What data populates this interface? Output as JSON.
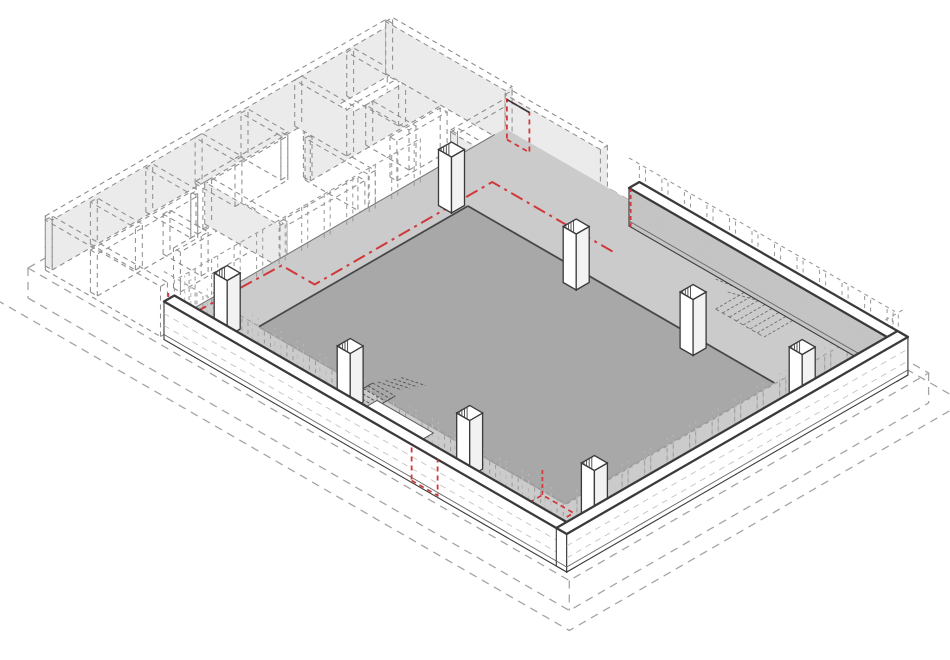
{
  "figure": {
    "description": "Axonometric demolition diagram: existing masonry walls shown dashed for removal, retained low perimeter walls on three sides, concrete floor slab with perimeter bands, eight columns with hatched tops, two stairs, red dash-dot lines and red dashed door openings marking demolition, all on a dashed base plinth"
  },
  "projection": {
    "ox": 28,
    "oy": 268,
    "c": 0.866,
    "s": 0.5
  },
  "colors": {
    "bg": "#ffffff",
    "slab_dark": "#a8a8a8",
    "slab_light": "#cbcbcb",
    "wall_white": "#ffffff",
    "wall_gray_face": "#c4c4c4",
    "col_side": "#f2f2f2",
    "line_dark": "#3a3a3a",
    "slab_edge": "#474747",
    "soft_edge": "#9b9b9b",
    "maze_line": "#8f8f8f",
    "maze_fill": "#ebebeb",
    "plinth_line": "#a5a5a5",
    "ghost_line": "#9c9c9c",
    "pier_light": "#b9b9b9",
    "course_line": "#c2c2c2",
    "stair_line": "#555555",
    "stairb_line": "#707070",
    "hatch": "#444444",
    "red": "#cf393b"
  },
  "plinth": {
    "A": 415,
    "B": 625,
    "depth": 30,
    "step": 20
  },
  "floors": {
    "light": {
      "u0": 19,
      "u1": 389,
      "v0": 150,
      "v1": 603,
      "z": 14
    },
    "dark": {
      "u0": 60,
      "u1": 302,
      "v0": 206,
      "v1": 560,
      "z": 14
    }
  },
  "walls": [
    {
      "name": "perimeter-wall-southwest",
      "u0": 7,
      "u1": 19,
      "v0": 150,
      "v1": 615,
      "h": 38,
      "mu": "wall_white",
      "pv": "wall_white"
    },
    {
      "name": "perimeter-wall-northeast",
      "u0": 389,
      "u1": 401,
      "v0": 305,
      "v1": 615,
      "h": 38,
      "mu": "wall_gray_face",
      "pv": "wall_white"
    },
    {
      "name": "perimeter-wall-southeast",
      "u0": 7,
      "u1": 401,
      "v0": 603,
      "v1": 615,
      "h": 38,
      "mu": "wall_white",
      "pv": "wall_white"
    }
  ],
  "ghost_planes": [
    {
      "name": "ghost-wall-above-southwest",
      "ax": "u",
      "at": 7,
      "a": 150,
      "b": 612,
      "z0": 38,
      "z1": 68,
      "color": "ghost_line",
      "top": true
    },
    {
      "name": "ghost-wall-above-northeast",
      "ax": "u",
      "at": 389,
      "a": 305,
      "b": 612,
      "z0": 38,
      "z1": 68,
      "color": "ghost_line",
      "top": true
    },
    {
      "name": "ghost-wall-above-southeast",
      "ax": "v",
      "at": 615,
      "a": 7,
      "b": 398,
      "z0": 38,
      "z1": 68,
      "color": "ghost_line",
      "top": true
    },
    {
      "name": "ghost-piers-inner-southwest",
      "ax": "u",
      "at": 19,
      "a": 150,
      "b": 600,
      "z0": 14,
      "z1": 64,
      "color": "pier_light",
      "top": false
    },
    {
      "name": "ghost-piers-inner-southeast",
      "ax": "v",
      "at": 603,
      "a": 19,
      "b": 389,
      "z0": 14,
      "z1": 64,
      "color": "pier_light",
      "top": false
    },
    {
      "name": "ghost-wall-northwest-edge",
      "ax": "v",
      "at": 155,
      "a": 19,
      "b": 296,
      "z0": 14,
      "z1": 58,
      "color": "ghost_line",
      "top": true
    }
  ],
  "ghost_spacing": 26,
  "courses": [
    {
      "ax": "u",
      "at": 7,
      "a": 150,
      "b": 615,
      "z": [
        14,
        26
      ]
    },
    {
      "ax": "v",
      "at": 615,
      "a": 7,
      "b": 401,
      "z": [
        14,
        26
      ]
    },
    {
      "ax": "u",
      "at": 389,
      "a": 305,
      "b": 615,
      "z": [
        14,
        26
      ]
    }
  ],
  "maze_walls": [
    {
      "t": "u",
      "at": 12,
      "a": 12,
      "b": 405,
      "h": 50,
      "f": 1
    },
    {
      "t": "u",
      "at": 64,
      "a": 12,
      "b": 128,
      "h": 42,
      "f": 0
    },
    {
      "t": "u",
      "at": 58,
      "a": 140,
      "b": 238,
      "h": 44,
      "f": 0
    },
    {
      "t": "u",
      "at": 72,
      "a": 250,
      "b": 405,
      "h": 44,
      "f": 1
    },
    {
      "t": "u",
      "at": 108,
      "a": 64,
      "b": 150,
      "h": 40,
      "f": 0
    },
    {
      "t": "u",
      "at": 145,
      "a": 150,
      "b": 240,
      "h": 42,
      "f": 0
    },
    {
      "t": "u",
      "at": 122,
      "a": 300,
      "b": 358,
      "h": 40,
      "f": 0
    },
    {
      "t": "v",
      "at": 12,
      "a": 12,
      "b": 145,
      "h": 50,
      "f": 0
    },
    {
      "t": "v",
      "at": 64,
      "a": 12,
      "b": 64,
      "h": 42,
      "f": 0
    },
    {
      "t": "v",
      "at": 96,
      "a": 64,
      "b": 108,
      "h": 40,
      "f": 0
    },
    {
      "t": "v",
      "at": 128,
      "a": 12,
      "b": 64,
      "h": 44,
      "f": 0
    },
    {
      "t": "v",
      "at": 150,
      "a": 58,
      "b": 145,
      "h": 42,
      "f": 1
    },
    {
      "t": "v",
      "at": 185,
      "a": 12,
      "b": 58,
      "h": 46,
      "f": 0
    },
    {
      "t": "v",
      "at": 238,
      "a": 12,
      "b": 58,
      "h": 44,
      "f": 0
    },
    {
      "t": "v",
      "at": 252,
      "a": 72,
      "b": 145,
      "h": 42,
      "f": 0
    },
    {
      "t": "v",
      "at": 300,
      "a": 12,
      "b": 72,
      "h": 46,
      "f": 1
    },
    {
      "t": "v",
      "at": 322,
      "a": 72,
      "b": 122,
      "h": 40,
      "f": 0
    },
    {
      "t": "v",
      "at": 360,
      "a": 12,
      "b": 72,
      "h": 44,
      "f": 0
    },
    {
      "t": "v",
      "at": 405,
      "a": 12,
      "b": 150,
      "h": 52,
      "f": 1
    },
    {
      "t": "v",
      "at": 340,
      "a": 152,
      "b": 300,
      "h": 44,
      "f": 1
    },
    {
      "t": "u",
      "at": 152,
      "a": 340,
      "b": 403,
      "h": 42,
      "f": 0
    },
    {
      "t": "u",
      "at": 185,
      "a": 340,
      "b": 403,
      "h": 42,
      "f": 0
    },
    {
      "t": "u",
      "at": 240,
      "a": 340,
      "b": 403,
      "h": 40,
      "f": 0
    },
    {
      "t": "v",
      "at": 403,
      "a": 152,
      "b": 262,
      "h": 50,
      "f": 1
    }
  ],
  "maze_thickness": 8,
  "columns": {
    "size": 15,
    "base_z": 14,
    "height": 56,
    "positions": [
      {
        "u": 293,
        "v": 196
      },
      {
        "u": 288,
        "v": 345
      },
      {
        "u": 40,
        "v": 190
      },
      {
        "u": 290,
        "v": 478
      },
      {
        "u": 38,
        "v": 334
      },
      {
        "u": 298,
        "v": 596
      },
      {
        "u": 40,
        "v": 470
      },
      {
        "u": 62,
        "v": 592
      }
    ]
  },
  "stairs": {
    "a": {
      "u0": 26,
      "u1": 70,
      "v0": 328,
      "v1": 354,
      "steps": 9,
      "z": 14,
      "plank": {
        "u0": 40,
        "u1": 53,
        "v0": 350,
        "v1": 415,
        "z": 16
      }
    },
    "b": {
      "u0": 342,
      "u1": 386,
      "v0": 452,
      "v1": 508,
      "steps": 8,
      "z": 14
    }
  },
  "red": {
    "main_line": [
      [
        12,
        154
      ],
      [
        135,
        158
      ],
      [
        135,
        196
      ],
      [
        296,
        196
      ],
      [
        340,
        196
      ],
      [
        340,
        340
      ]
    ],
    "main_z": 14,
    "w_tick": {
      "u": 10,
      "v": 152,
      "z0": 14,
      "z1": 46
    },
    "ne_wall_tick": {
      "u": 389,
      "v": 307,
      "z0": 0,
      "z1": 38
    },
    "ne_door": {
      "ax": "u",
      "at": 403,
      "a": 150,
      "b": 176,
      "z0": 2,
      "z1": 42
    },
    "sw_door": {
      "ax": "u",
      "at": 7,
      "a": 436,
      "b": 466,
      "z0": 2,
      "z1": 38
    },
    "se_floor_rect": {
      "u0": 14,
      "u1": 56,
      "v0": 538,
      "v1": 574,
      "z": 14
    },
    "se_floor_tick": {
      "u": 56,
      "v": 538,
      "z0": 14,
      "z1": 40
    }
  }
}
